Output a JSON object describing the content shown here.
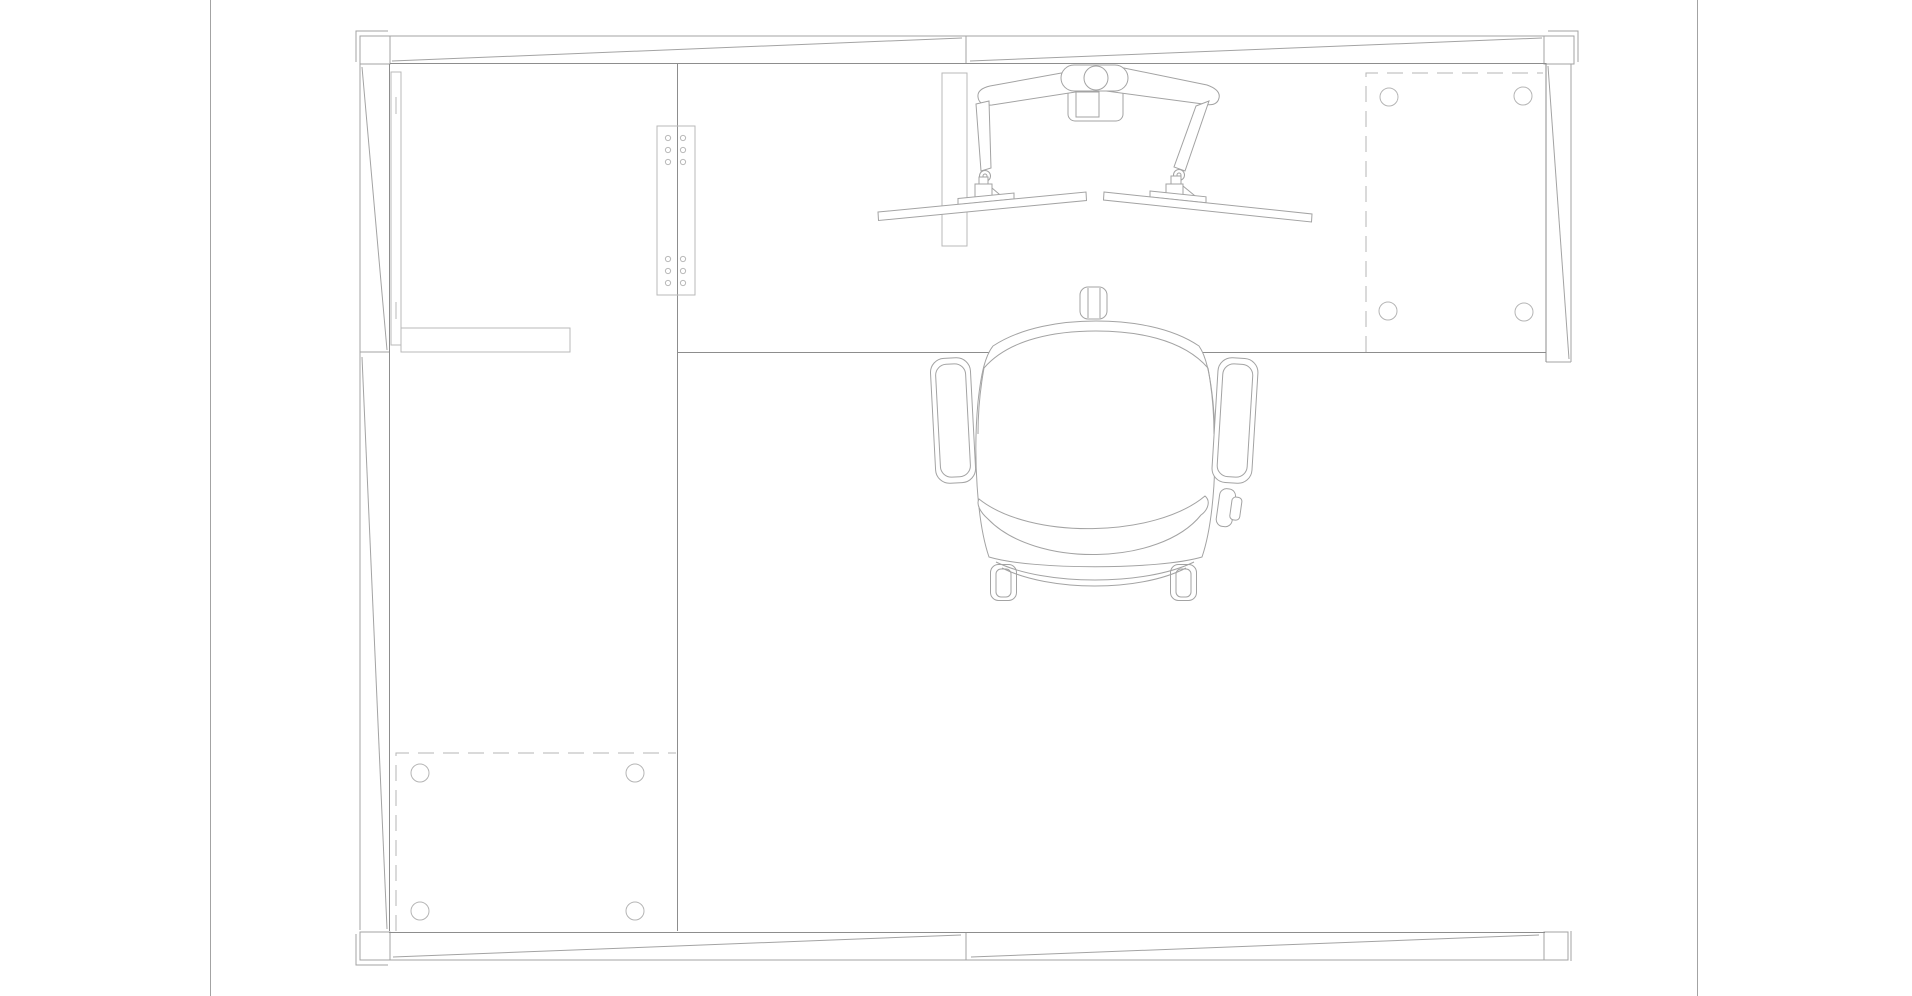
{
  "document": {
    "type": "cad-technical-drawing",
    "view": "top-plan-view",
    "subject": "Office cubicle workstation: L-shaped desk with panel walls, dual-monitor arm and task chair",
    "background": "#ffffff",
    "has_text": false
  },
  "colors": {
    "line_light": "#b9b9b9",
    "line_medium": "#a3a3a3",
    "line_dark": "#8d8d8d",
    "dashed_line": "#b5b5b5",
    "paper": "#ffffff"
  },
  "strokes": {
    "width": 1,
    "dash_pattern": "16 9"
  },
  "sheet": {
    "left_border_x": 210,
    "right_border_x": 1697,
    "height": 996
  },
  "components": {
    "panel_walls": {
      "description": "Cubicle panels with diagonal panel marks and corner posts",
      "top_panel": {
        "x1": 388,
        "y1": 36,
        "x2": 1546,
        "y2": 63,
        "split_x": 966,
        "panels": 2
      },
      "left_panel": {
        "x1": 360,
        "y1": 63,
        "x2": 389,
        "y2": 932,
        "split_y": 352,
        "panels": 2
      },
      "right_panel": {
        "x1": 1546,
        "y1": 63,
        "x2": 1571,
        "y2": 362,
        "panels": 1
      },
      "bottom_panel": {
        "x1": 389,
        "y1": 932,
        "x2": 1545,
        "y2": 960,
        "split_x": 966,
        "panels": 2
      },
      "corner_posts": 4
    },
    "desk": {
      "description": "L-shaped worksurface along top and left panels",
      "main_surface": {
        "x1": 389,
        "y1": 63,
        "x2": 1546,
        "y2": 352
      },
      "return_surface": {
        "x1": 389,
        "y1": 352,
        "x2": 677,
        "y2": 932
      },
      "front_edge_y": 352,
      "return_edge_x": 677
    },
    "connector_plate": {
      "description": "Joining plate with screw holes on worksurface seam",
      "rect": {
        "x": 657,
        "y": 126,
        "w": 38,
        "h": 169
      },
      "hole_columns_x": [
        668,
        683
      ],
      "hole_rows_y": [
        138,
        150,
        162,
        259,
        271,
        283
      ],
      "hole_count": 12,
      "hole_radius": 2.6
    },
    "modesty_panel": {
      "rect": {
        "x": 391,
        "y": 72,
        "w": 10,
        "h": 273
      },
      "hinge_ticks": 2
    },
    "pencil_shelf": {
      "rect": {
        "x": 401,
        "y": 328,
        "w": 169,
        "h": 24
      }
    },
    "bracket_panel": {
      "rect": {
        "x": 942,
        "y": 73,
        "w": 25,
        "h": 173
      }
    },
    "pedestal_top_right": {
      "description": "Under-desk pedestal shown with hidden (dashed) lines and 4 leg circles",
      "x1": 1366,
      "y1": 73,
      "x2": 1543,
      "y2": 352,
      "leg_circles": [
        [
          1389,
          97
        ],
        [
          1523,
          96
        ],
        [
          1388,
          311
        ],
        [
          1524,
          312
        ]
      ],
      "leg_radius": 9
    },
    "pedestal_bottom_left": {
      "description": "Under-desk pedestal shown with hidden (dashed) lines and 4 leg circles",
      "x1": 396,
      "y1": 753,
      "x2": 676,
      "y2": 931,
      "leg_circles": [
        [
          420,
          773
        ],
        [
          635,
          773
        ],
        [
          420,
          911
        ],
        [
          635,
          911
        ]
      ],
      "leg_radius": 9
    },
    "monitor_arm": {
      "description": "Dual-monitor articulating arm clamped to desk back edge",
      "clamp_pill": {
        "x": 1061,
        "y": 65,
        "w": 67,
        "h": 26
      },
      "pole_circle": {
        "cx": 1096,
        "cy": 78,
        "r": 12
      },
      "mount_bracket": {
        "x": 1068,
        "y": 87,
        "w": 55,
        "h": 34
      },
      "monitors": 2,
      "left_monitor_span": [
        [
          878,
          212
        ],
        [
          1086,
          192
        ]
      ],
      "right_monitor_span": [
        [
          1104,
          192
        ],
        [
          1312,
          214
        ]
      ]
    },
    "task_chair": {
      "description": "Office task chair, top view",
      "seat_bbox": {
        "x1": 973,
        "y1": 320,
        "x2": 1218,
        "y2": 570
      },
      "headrest": {
        "x": 1080,
        "y": 287,
        "w": 27,
        "h": 32
      },
      "armrests": 2,
      "casters_visible": 2,
      "adjustment_lever": {
        "x": 1218,
        "y": 489
      }
    }
  }
}
